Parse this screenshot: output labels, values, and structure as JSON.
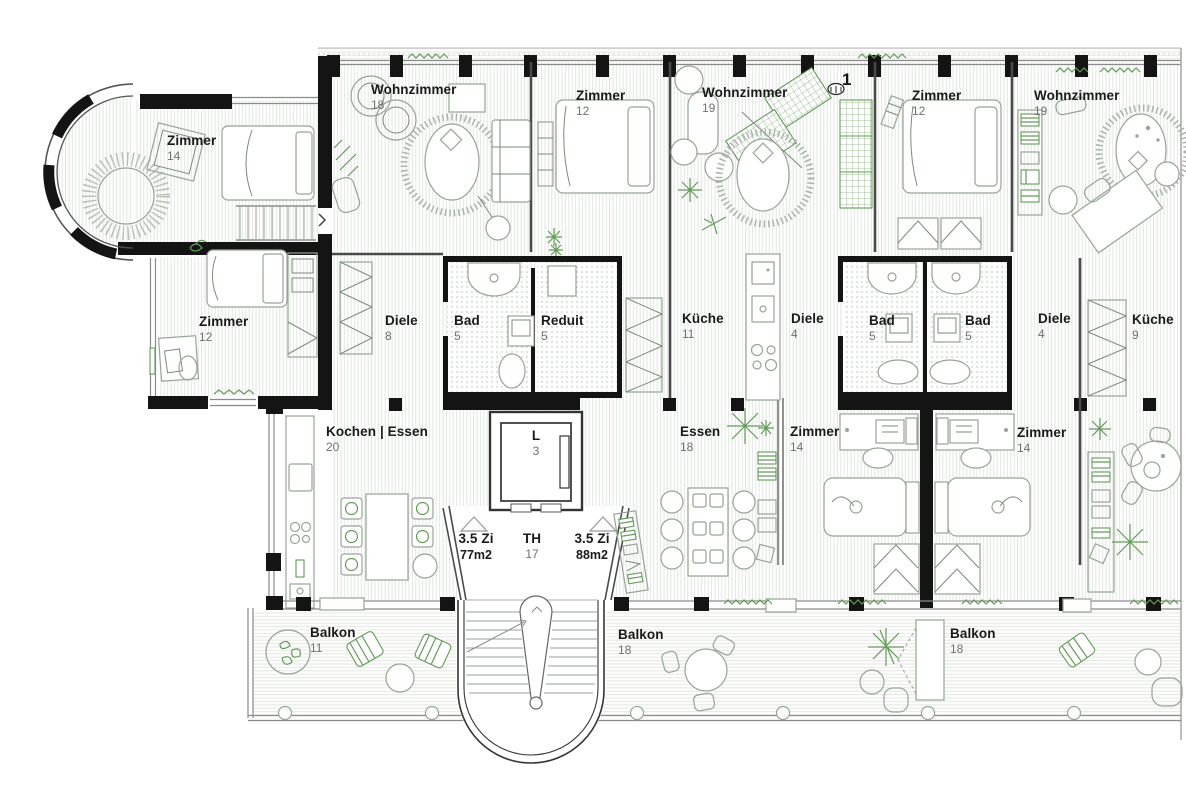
{
  "title": "Grundriss Obergeschoss",
  "colors": {
    "wall": "#141414",
    "furniture_line": "#97a497",
    "green_accent": "#639a58",
    "floor_hatch": "#e3e7e3",
    "bath_dots": "#c7cec7",
    "label_text": "#1a1a1a",
    "label_number": "#707070"
  },
  "rooms": {
    "zimmer_tower": {
      "name": "Zimmer",
      "num": "14"
    },
    "zimmer_left": {
      "name": "Zimmer",
      "num": "12"
    },
    "wohnzimmer_a": {
      "name": "Wohnzimmer",
      "num": "18"
    },
    "zimmer_top_a": {
      "name": "Zimmer",
      "num": "12"
    },
    "wohnzimmer_b": {
      "name": "Wohnzimmer",
      "num": "19"
    },
    "zimmer_top_b": {
      "name": "Zimmer",
      "num": "12"
    },
    "wohnzimmer_c": {
      "name": "Wohnzimmer",
      "num": "19"
    },
    "diele_a": {
      "name": "Diele",
      "num": "8"
    },
    "bad_a": {
      "name": "Bad",
      "num": "5"
    },
    "reduit": {
      "name": "Reduit",
      "num": "5"
    },
    "kueche_a": {
      "name": "Küche",
      "num": "11"
    },
    "diele_b": {
      "name": "Diele",
      "num": "4"
    },
    "bad_b": {
      "name": "Bad",
      "num": "5"
    },
    "bad_c": {
      "name": "Bad",
      "num": "5"
    },
    "diele_c": {
      "name": "Diele",
      "num": "4"
    },
    "kueche_b": {
      "name": "Küche",
      "num": "9"
    },
    "kochen_essen": {
      "name": "Kochen | Essen",
      "num": "20"
    },
    "essen": {
      "name": "Essen",
      "num": "18"
    },
    "zimmer_mid_a": {
      "name": "Zimmer",
      "num": "14"
    },
    "zimmer_mid_b": {
      "name": "Zimmer",
      "num": "14"
    },
    "balkon_a": {
      "name": "Balkon",
      "num": "11"
    },
    "balkon_b": {
      "name": "Balkon",
      "num": "18"
    },
    "balkon_c": {
      "name": "Balkon",
      "num": "18"
    }
  },
  "core": {
    "lift": {
      "name": "L",
      "num": "3"
    },
    "stairwell": {
      "name": "TH",
      "num": "17"
    },
    "unit_left": {
      "name": "3.5 Zi",
      "area": "77m2"
    },
    "unit_right": {
      "name": "3.5 Zi",
      "area": "88m2"
    },
    "marker": "1"
  }
}
